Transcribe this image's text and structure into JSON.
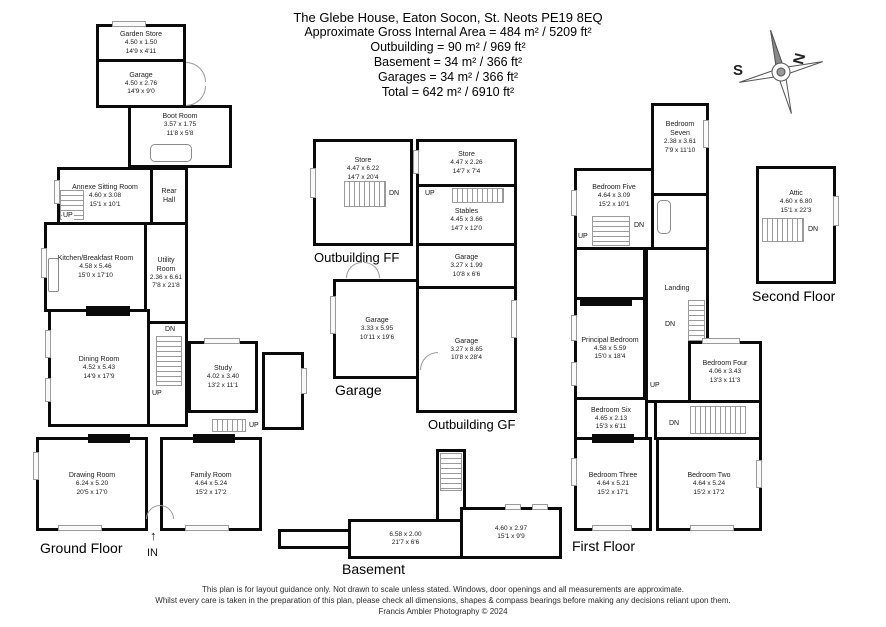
{
  "title_block": {
    "address": "The Glebe House, Eaton Socon, St. Neots PE19 8EQ",
    "gross_area": "Approximate Gross Internal Area = 484 m² / 5209 ft²",
    "outbuilding": "Outbuilding = 90 m² / 969 ft²",
    "basement": "Basement = 34 m² / 366 ft²",
    "garages": "Garages = 34 m² / 366 ft²",
    "total": "Total = 642 m² / 6910 ft²"
  },
  "compass": {
    "south": "S",
    "north": "N"
  },
  "stair_labels": {
    "up": "UP",
    "dn": "DN"
  },
  "entrance_label": "IN",
  "icons": {
    "entrance_arrow": "↑"
  },
  "floors": {
    "ground": {
      "label": "Ground Floor",
      "rooms": {
        "garden_store": {
          "name": "Garden Store",
          "metric": "4.50 x 1.50",
          "imperial": "14'9 x 4'11"
        },
        "garage": {
          "name": "Garage",
          "metric": "4.50 x 2.76",
          "imperial": "14'9 x 9'0"
        },
        "boot_room": {
          "name": "Boot Room",
          "metric": "3.57 x 1.75",
          "imperial": "11'8 x 5'8"
        },
        "annexe_sitting_room": {
          "name": "Annexe Sitting Room",
          "metric": "4.60 x 3.08",
          "imperial": "15'1 x 10'1"
        },
        "rear_hall": {
          "name": "Rear Hall"
        },
        "utility_room": {
          "name": "Utility Room",
          "metric": "2.36 x 6.61",
          "imperial": "7'8 x 21'8"
        },
        "kitchen": {
          "name": "Kitchen/Breakfast Room",
          "metric": "4.58 x 5.46",
          "imperial": "15'0 x 17'10"
        },
        "dining_room": {
          "name": "Dining Room",
          "metric": "4.52 x 5.43",
          "imperial": "14'9 x 17'9"
        },
        "study": {
          "name": "Study",
          "metric": "4.02 x 3.40",
          "imperial": "13'2 x 11'1"
        },
        "drawing_room": {
          "name": "Drawing Room",
          "metric": "6.24 x 5.20",
          "imperial": "20'5 x 17'0"
        },
        "family_room": {
          "name": "Family Room",
          "metric": "4.64 x 5.24",
          "imperial": "15'2 x 17'2"
        }
      }
    },
    "first": {
      "label": "First Floor",
      "rooms": {
        "bedroom_seven": {
          "name": "Bedroom Seven",
          "metric": "2.38 x 3.61",
          "imperial": "7'9 x 11'10"
        },
        "bedroom_five": {
          "name": "Bedroom Five",
          "metric": "4.64 x 3.09",
          "imperial": "15'2 x 10'1"
        },
        "landing": {
          "name": "Landing"
        },
        "principal_bedroom": {
          "name": "Principal Bedroom",
          "metric": "4.58 x 5.59",
          "imperial": "15'0 x 18'4"
        },
        "bedroom_four": {
          "name": "Bedroom Four",
          "metric": "4.06 x 3.43",
          "imperial": "13'3 x 11'3"
        },
        "bedroom_six": {
          "name": "Bedroom Six",
          "metric": "4.65 x 2.13",
          "imperial": "15'3 x 6'11"
        },
        "bedroom_three": {
          "name": "Bedroom Three",
          "metric": "4.64 x 5.21",
          "imperial": "15'2 x 17'1"
        },
        "bedroom_two": {
          "name": "Bedroom Two",
          "metric": "4.64 x 5.24",
          "imperial": "15'2 x 17'2"
        }
      }
    },
    "second": {
      "label": "Second Floor",
      "rooms": {
        "attic": {
          "name": "Attic",
          "metric": "4.60 x 6.80",
          "imperial": "15'1 x 22'3"
        }
      }
    }
  },
  "outbuilding_ff": {
    "label": "Outbuilding FF",
    "rooms": {
      "store": {
        "name": "Store",
        "metric": "4.47 x 6.22",
        "imperial": "14'7 x 20'4"
      }
    }
  },
  "garage_block": {
    "label": "Garage",
    "rooms": {
      "garage": {
        "name": "Garage",
        "metric": "3.33 x 5.95",
        "imperial": "10'11 x 19'6"
      }
    }
  },
  "outbuilding_gf": {
    "label": "Outbuilding GF",
    "rooms": {
      "store": {
        "name": "Store",
        "metric": "4.47 x 2.26",
        "imperial": "14'7 x 7'4"
      },
      "stables": {
        "name": "Stables",
        "metric": "4.45 x 3.66",
        "imperial": "14'7 x 12'0"
      },
      "garage_small": {
        "name": "Garage",
        "metric": "3.27 x 1.99",
        "imperial": "10'8 x 6'6"
      },
      "garage_long": {
        "name": "Garage",
        "metric": "3.27 x 8.65",
        "imperial": "10'8 x 28'4"
      }
    }
  },
  "basement": {
    "label": "Basement",
    "rooms": {
      "room_a": {
        "metric": "6.58 x 2.00",
        "imperial": "21'7 x 6'6"
      },
      "room_b": {
        "metric": "4.60 x 2.97",
        "imperial": "15'1 x 9'9"
      }
    }
  },
  "footer": {
    "line1": "This plan is for layout guidance only. Not drawn to scale unless stated. Windows, door openings and all measurements are approximate.",
    "line2": "Whilst every care is taken in the preparation of this plan, please check all dimensions, shapes & compass bearings before making any decisions reliant upon them.",
    "line3": "Francis Ambler Photography © 2024"
  }
}
